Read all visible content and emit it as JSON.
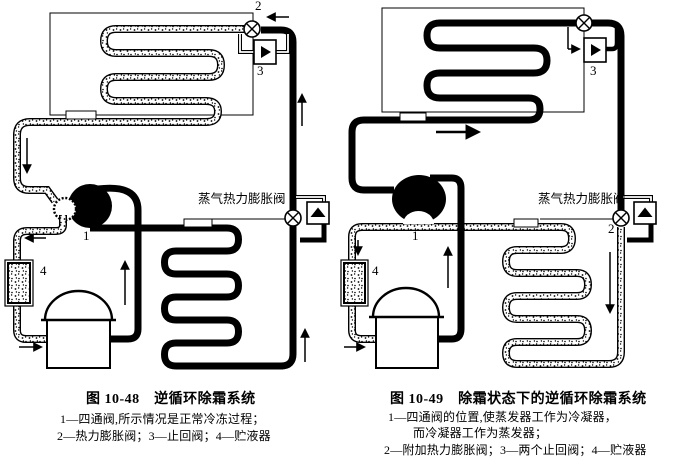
{
  "page": {
    "background": "#ffffff",
    "ink": "#000000"
  },
  "figures": [
    {
      "caption": "图 10-48　逆循环除霜系统",
      "legend": [
        "1—四通阀,所示情况是正常冷冻过程；",
        "2—热力膨胀阀；3—止回阀；4—贮液器"
      ],
      "labels": {
        "four_way_valve": "1",
        "thermal_expansion_valve": "2",
        "check_valve": "3",
        "receiver": "4",
        "vapor_txv_label": "蒸气热力膨胀阀"
      }
    },
    {
      "caption": "图 10-49　除霜状态下的逆循环除霜系统",
      "legend": [
        "1—四通阀的位置,使蒸发器工作为冷凝器，",
        "而冷凝器工作为蒸发器；",
        "2—附加热力膨胀阀；3—两个止回阀；4—贮液器"
      ],
      "labels": {
        "four_way_valve": "1",
        "additional_expansion_valve": "2",
        "check_valve": "3",
        "receiver": "4",
        "vapor_txv_label": "蒸气热力膨胀阀"
      }
    }
  ]
}
